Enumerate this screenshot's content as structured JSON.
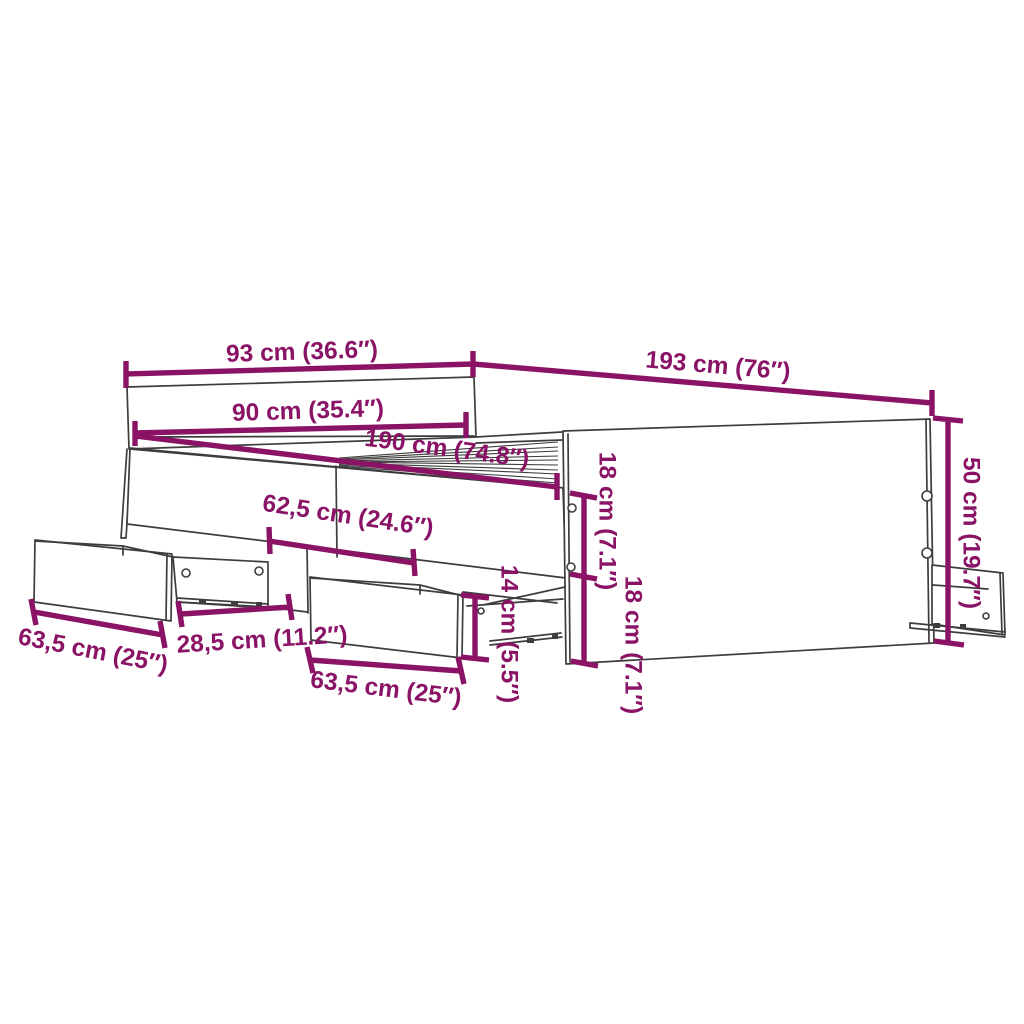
{
  "diagram": {
    "kind": "furniture-dimension-diagram",
    "subject": "bed frame with headboard, side panel and pull-out storage drawers",
    "units": [
      "cm",
      "inches"
    ],
    "colors": {
      "accent": "#8A1366",
      "line": "#3D3D3D",
      "background": "#FFFFFF"
    },
    "dimensions": {
      "headboard_width": {
        "label": "93 cm (36.6″)",
        "value_cm": 93,
        "value_in": 36.6
      },
      "frame_length": {
        "label": "193 cm (76″)",
        "value_cm": 193,
        "value_in": 76
      },
      "inner_width": {
        "label": "90 cm (35.4″)",
        "value_cm": 90,
        "value_in": 35.4
      },
      "inner_length": {
        "label": "190 cm (74.8″)",
        "value_cm": 190,
        "value_in": 74.8
      },
      "drawer_offset": {
        "label": "62,5 cm (24.6″)",
        "value_cm": 62.5,
        "value_in": 24.6
      },
      "drawer_height": {
        "label": "14 cm (5.5″)",
        "value_cm": 14,
        "value_in": 5.5
      },
      "rail_upper_height": {
        "label": "18 cm (7.1″)",
        "value_cm": 18,
        "value_in": 7.1
      },
      "rail_lower_height": {
        "label": "18 cm (7.1″)",
        "value_cm": 18,
        "value_in": 7.1
      },
      "side_height": {
        "label": "50 cm (19.7″)",
        "value_cm": 50,
        "value_in": 19.7
      },
      "drawer1_width": {
        "label": "63,5 cm (25″)",
        "value_cm": 63.5,
        "value_in": 25
      },
      "drawer_gap": {
        "label": "28,5 cm (11.2″)",
        "value_cm": 28.5,
        "value_in": 11.2
      },
      "drawer2_width": {
        "label": "63,5 cm (25″)",
        "value_cm": 63.5,
        "value_in": 25
      }
    }
  }
}
